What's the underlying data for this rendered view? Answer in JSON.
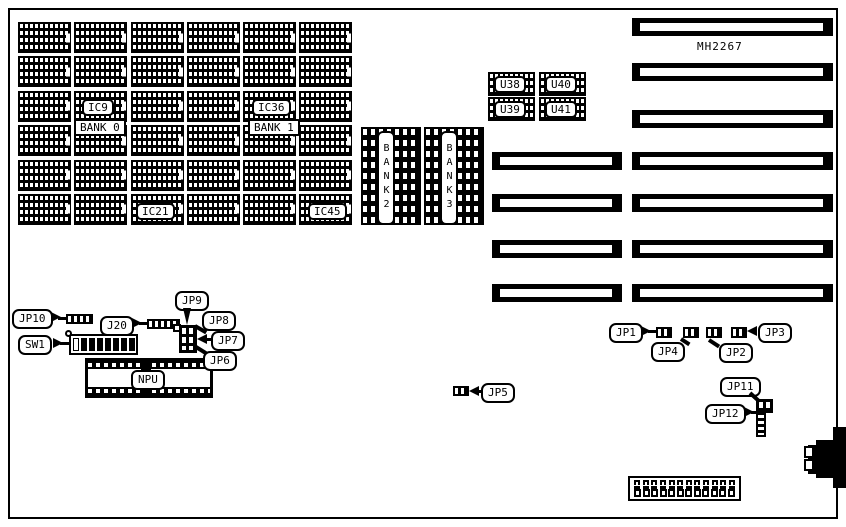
{
  "board_name": "MH2267",
  "memory": {
    "ic9": "IC9",
    "bank0": "BANK 0",
    "ic36": "IC36",
    "bank1": "BANK 1",
    "ic21": "IC21",
    "ic45": "IC45",
    "bank2": "BANK2",
    "bank3": "BANK3"
  },
  "chips": {
    "u38": "U38",
    "u40": "U40",
    "u39": "U39",
    "u41": "U41"
  },
  "callouts": {
    "jp1": "JP1",
    "jp2": "JP2",
    "jp3": "JP3",
    "jp4": "JP4",
    "jp5": "JP5",
    "jp6": "JP6",
    "jp7": "JP7",
    "jp8": "JP8",
    "jp9": "JP9",
    "jp10": "JP10",
    "jp11": "JP11",
    "jp12": "JP12",
    "j20": "J20",
    "sw1": "SW1",
    "npu": "NPU"
  }
}
